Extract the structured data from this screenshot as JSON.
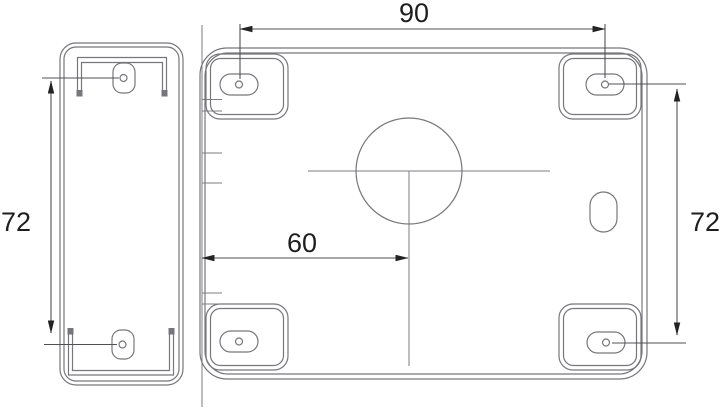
{
  "drawing": {
    "title": "lock-mounting-plates-dimension-drawing",
    "dims": {
      "top_width": "90",
      "left_height": "72",
      "center_offset": "60",
      "right_height": "72"
    },
    "colors": {
      "background": "#ffffff",
      "geometry_line": "#77777b",
      "dimension_line": "#515155",
      "text": "#1e1e1e"
    }
  }
}
